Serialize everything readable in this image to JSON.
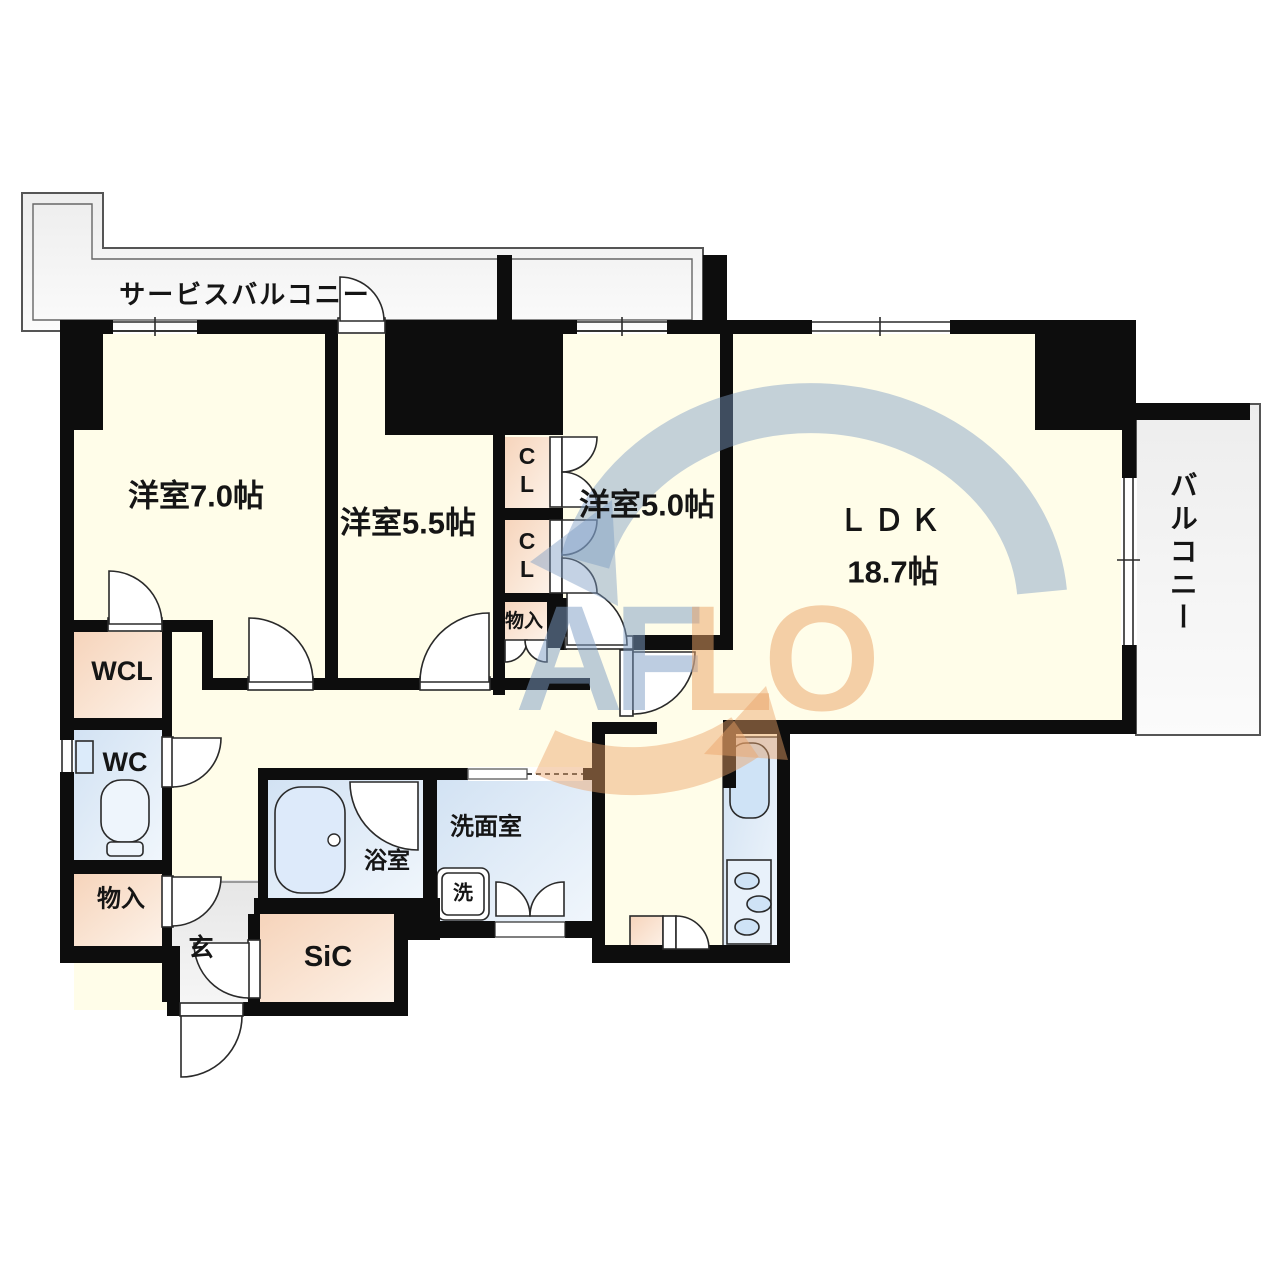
{
  "plan": {
    "service_balcony": "サービスバルコニー",
    "balcony": "バルコニー",
    "bedroom_7": "洋室7.0帖",
    "bedroom_55": "洋室5.5帖",
    "bedroom_5": "洋室5.0帖",
    "ldk": "ＬＤＫ",
    "ldk_size": "18.7帖",
    "walk_in_closet": "WCL",
    "toilet": "WC",
    "storage_left": "物入",
    "storage_mid": "物入",
    "entrance": "玄",
    "shoes_in_closet": "SiC",
    "bathroom": "浴室",
    "washroom": "洗面室",
    "washer": "洗",
    "closet_upper": "CL",
    "closet_lower": "CL"
  },
  "watermark": {
    "left": "AF",
    "right": "LO",
    "blue": "#7d9cc4",
    "orange": "#eaa266"
  },
  "colors": {
    "wall": "#0d0d0d",
    "room_floor": "#fffde9",
    "closet_floor": "#f8dcc6",
    "wet_area_floor": "#d9e8f7",
    "entrance_floor": "#e9e9e9",
    "balcony_floor": "#f3f3f3"
  }
}
